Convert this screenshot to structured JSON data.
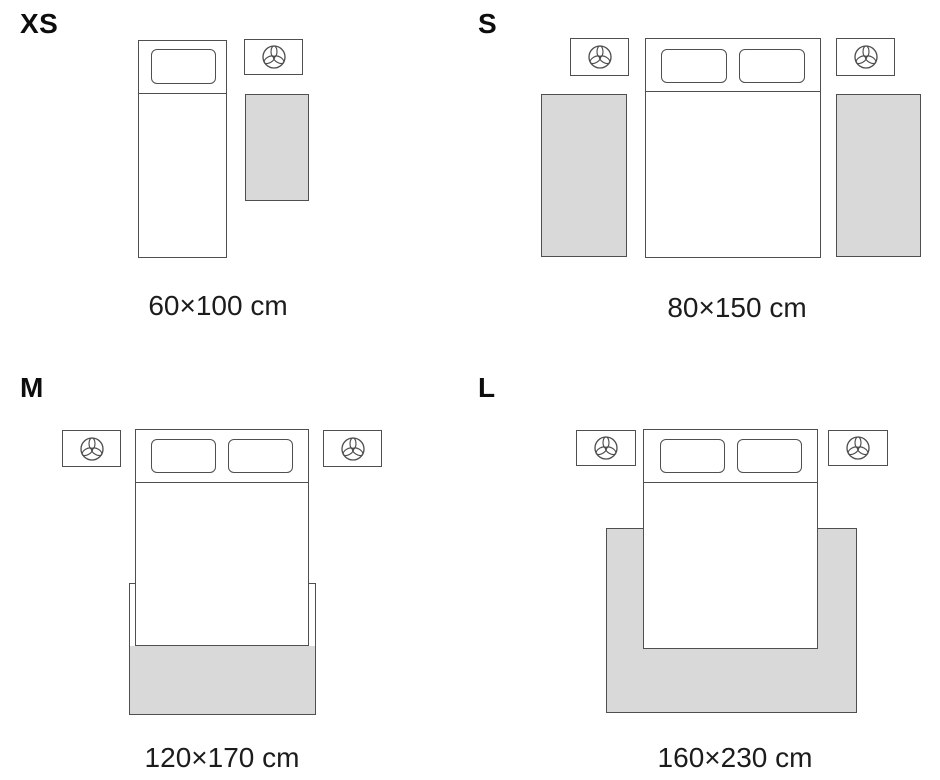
{
  "page": {
    "type": "rug-size-guide-diagram",
    "background": "#ffffff"
  },
  "colors": {
    "rug_fill": "#d9d9d9",
    "outline": "#4f4f4f",
    "text": "#111111"
  },
  "icons": {
    "nightstand_icon": "plant-trefoil-icon"
  },
  "sizes": {
    "xs": {
      "label": "XS",
      "dimensions": "60×100 cm"
    },
    "s": {
      "label": "S",
      "dimensions": "80×150 cm"
    },
    "m": {
      "label": "M",
      "dimensions": "120×170 cm"
    },
    "l": {
      "label": "L",
      "dimensions": "160×230 cm"
    }
  }
}
